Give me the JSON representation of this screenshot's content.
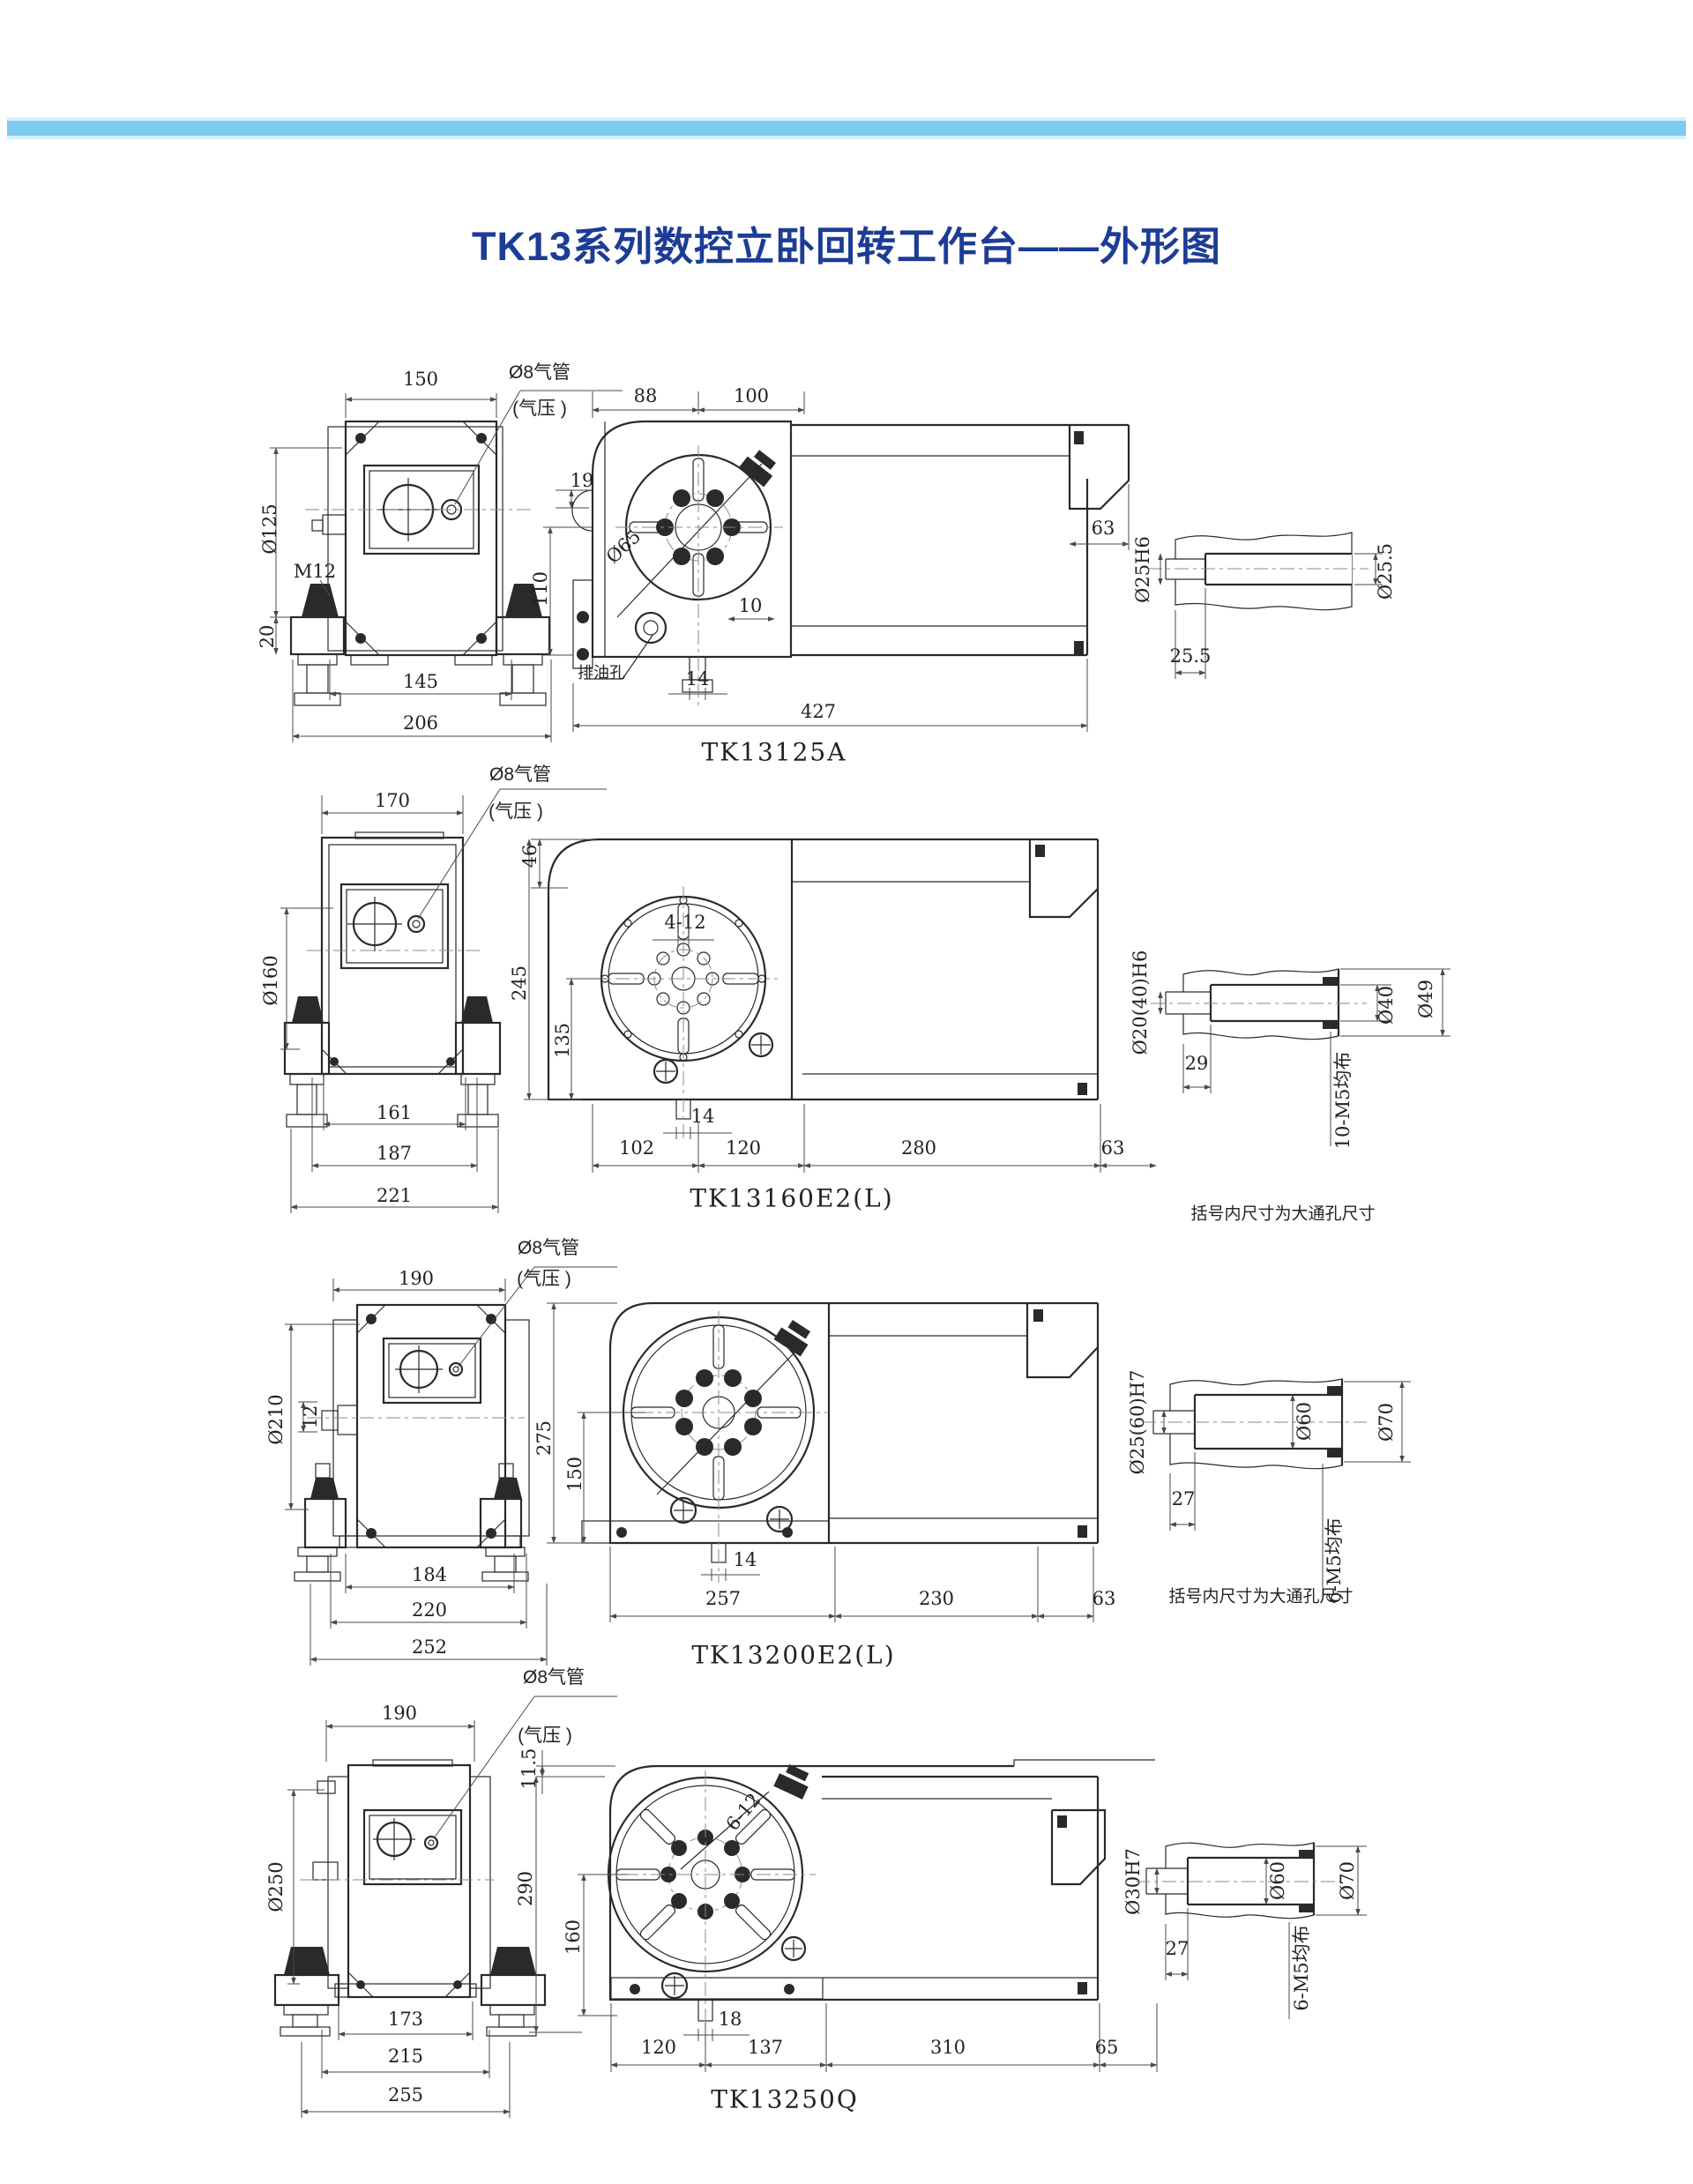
{
  "page": {
    "title": "TK13系列数控立卧回转工作台——外形图",
    "title_color": "#1c3c96",
    "header_bar_color": "#7dccf0",
    "header_bar_edge_color": "#d6f0fb",
    "background_color": "#ffffff",
    "line_color": "#2a2a2a"
  },
  "rows": [
    {
      "model": "TK13125A",
      "front": {
        "pipe_label": "Ø8气管",
        "pressure_label": "(气压 )",
        "width_top": "150",
        "body_dia": "Ø125",
        "bolt_label": "M12",
        "foot_height": "20",
        "width_feet": "145",
        "width_base": "206"
      },
      "side": {
        "w88": "88",
        "w100": "100",
        "h19": "19",
        "h110": "110",
        "bolt_circle": "Ø65",
        "w10": "10",
        "w14": "14",
        "drain_label": "排油孔",
        "total_length": "427",
        "right_width": "63"
      },
      "detail": {
        "bore_left": "Ø25H6",
        "bore_right": "Ø25.5",
        "depth": "25.5"
      }
    },
    {
      "model": "TK13160E2(L)",
      "front": {
        "pipe_label": "Ø8气管",
        "pressure_label": "(气压 )",
        "width_top": "170",
        "body_dia": "Ø160",
        "w161": "161",
        "w187": "187",
        "w221": "221"
      },
      "side": {
        "h46": "46",
        "h245": "245",
        "h135": "135",
        "slot_label": "4-12",
        "w14": "14",
        "w102": "102",
        "w120": "120",
        "w280": "280",
        "right_width": "63"
      },
      "detail": {
        "bore": "Ø20(40)H6",
        "d29": "29",
        "d40": "Ø40",
        "d49": "Ø49",
        "thread_note": "10-M5均布",
        "bracket_note": "括号内尺寸为大通孔尺寸"
      }
    },
    {
      "model": "TK13200E2(L)",
      "front": {
        "pipe_label": "Ø8气管",
        "pressure_label": "(气压 )",
        "width_top": "190",
        "body_dia": "Ø210",
        "h12": "12",
        "w184": "184",
        "w220": "220",
        "w252": "252"
      },
      "side": {
        "h275": "275",
        "h150": "150",
        "w14": "14",
        "w257": "257",
        "w230": "230",
        "right_width": "63"
      },
      "detail": {
        "bore": "Ø25(60)H7",
        "d27": "27",
        "d60": "Ø60",
        "d70": "Ø70",
        "thread_note": "6-M5均布",
        "bracket_note": "括号内尺寸为大通孔尺寸"
      }
    },
    {
      "model": "TK13250Q",
      "front": {
        "pipe_label": "Ø8气管",
        "pressure_label": "(气压 )",
        "width_top": "190",
        "body_dia": "Ø250",
        "w173": "173",
        "w215": "215",
        "w255": "255"
      },
      "side": {
        "h115": "11.5",
        "h290": "290",
        "h160": "160",
        "slot_label": "6-12",
        "w18": "18",
        "w120": "120",
        "w137": "137",
        "w310": "310",
        "right_width": "65"
      },
      "detail": {
        "bore": "Ø30H7",
        "d27": "27",
        "d60": "Ø60",
        "d70": "Ø70",
        "thread_note": "6-M5均布"
      }
    }
  ]
}
